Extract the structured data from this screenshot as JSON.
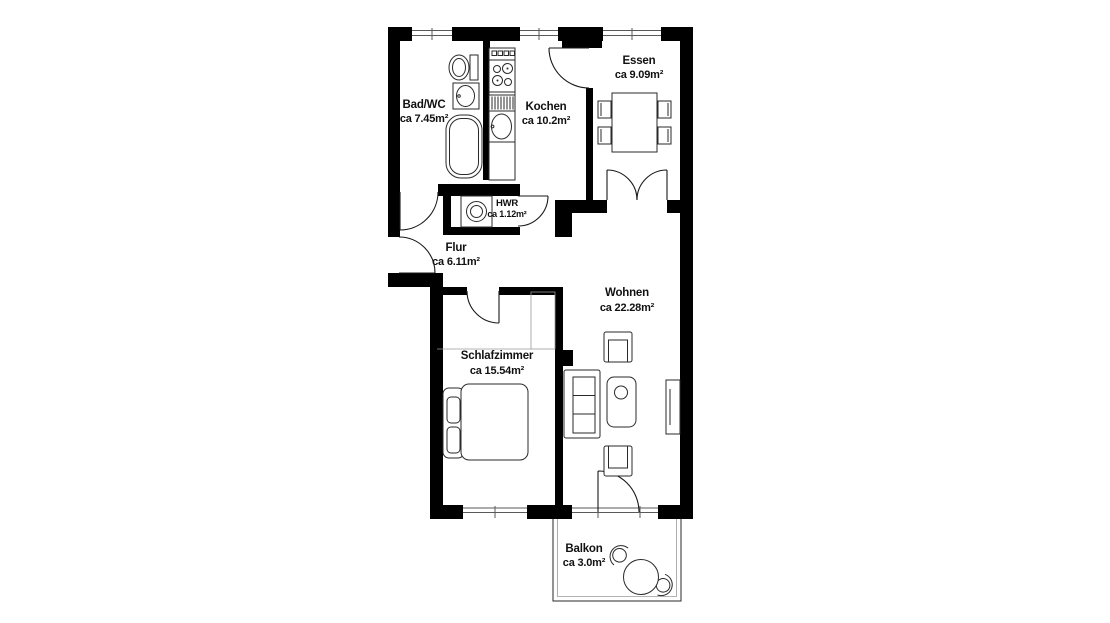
{
  "plan": {
    "colors": {
      "wall": "#000000",
      "background": "#ffffff",
      "line": "#1a1a1a"
    },
    "rooms": [
      {
        "id": "bad",
        "name": "Bad/WC",
        "area": "ca 7.45m²"
      },
      {
        "id": "kochen",
        "name": "Kochen",
        "area": "ca 10.2m²"
      },
      {
        "id": "essen",
        "name": "Essen",
        "area": "ca 9.09m²"
      },
      {
        "id": "hwr",
        "name": "HWR",
        "area": "ca 1.12m²"
      },
      {
        "id": "flur",
        "name": "Flur",
        "area": "ca 6.11m²"
      },
      {
        "id": "wohnen",
        "name": "Wohnen",
        "area": "ca 22.28m²"
      },
      {
        "id": "schlafzimmer",
        "name": "Schlafzimmer",
        "area": "ca 15.54m²"
      },
      {
        "id": "balkon",
        "name": "Balkon",
        "area": "ca 3.0m²"
      }
    ]
  }
}
